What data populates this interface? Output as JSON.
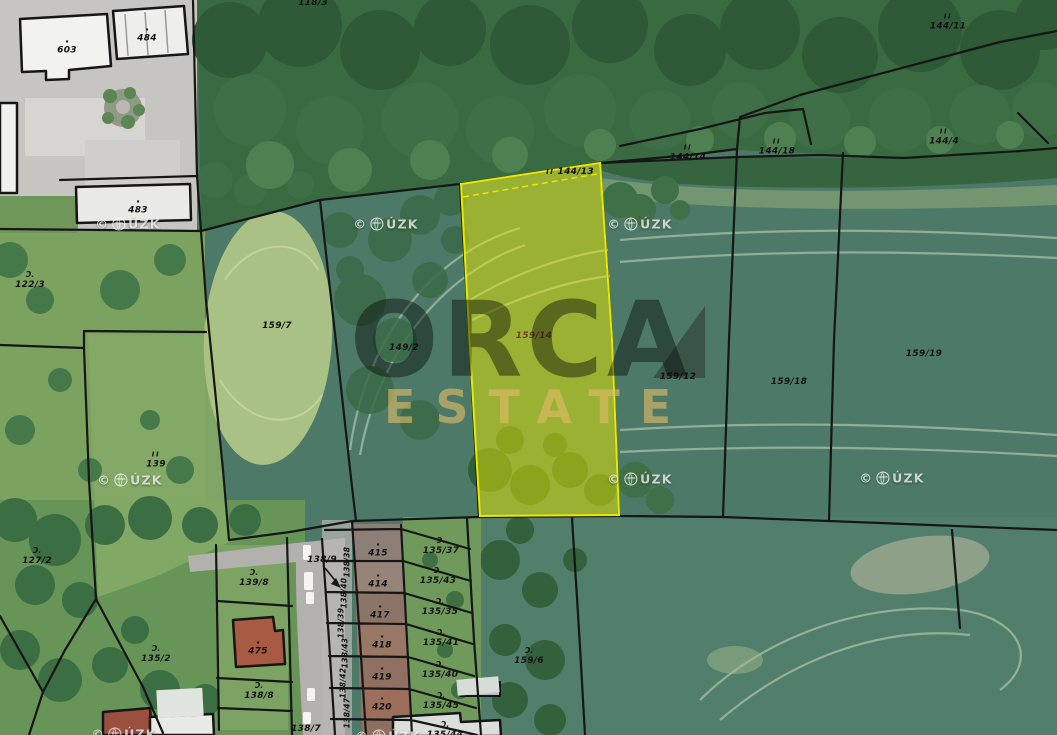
{
  "app": {
    "type": "cadastral-aerial-map",
    "provider": "ČÚZK",
    "brand": "ORCA ESTATE"
  },
  "map": {
    "brand_watermark": {
      "line1": "ORCA",
      "line2": "ESTATE"
    },
    "watermark": {
      "copyright": "©",
      "org": "ČÚZK",
      "org_suffix": "ÚZK",
      "positions": [
        {
          "x": 128,
          "y": 224
        },
        {
          "x": 386,
          "y": 224
        },
        {
          "x": 640,
          "y": 224
        },
        {
          "x": 130,
          "y": 480
        },
        {
          "x": 640,
          "y": 479
        },
        {
          "x": 892,
          "y": 478
        },
        {
          "x": 124,
          "y": 734
        },
        {
          "x": 388,
          "y": 736
        }
      ]
    },
    "highlight": {
      "parcel": "159/14",
      "stroke": "#eaea00",
      "fill": "rgba(232,232,0,0.5)"
    },
    "colors": {
      "boundary": "#161616",
      "forest": "#3a6a42",
      "field": "#4d7a68",
      "meadow": "#a9c184",
      "road": "#b2b1ad",
      "building": "#f2f2ef",
      "roof_red": "#a1543f",
      "highlight": "#eaea00"
    },
    "labels": [
      {
        "t": "603",
        "x": 67,
        "y": 47,
        "s": "dot"
      },
      {
        "t": "484",
        "x": 147,
        "y": 35,
        "s": "dot"
      },
      {
        "t": "483",
        "x": 138,
        "y": 207,
        "s": "dot"
      },
      {
        "t": "118/3",
        "x": 313,
        "y": 3
      },
      {
        "t": "144/11",
        "x": 948,
        "y": 22,
        "s": "II"
      },
      {
        "t": "144/14",
        "x": 688,
        "y": 153,
        "s": "II"
      },
      {
        "t": "144/18",
        "x": 777,
        "y": 147,
        "s": "II"
      },
      {
        "t": "144/4",
        "x": 944,
        "y": 137,
        "s": "II"
      },
      {
        "t": "144/13",
        "x": 570,
        "y": 172,
        "s": "II-inline"
      },
      {
        "t": "122/3",
        "x": 30,
        "y": 280,
        "s": "orchard"
      },
      {
        "t": "159/7",
        "x": 277,
        "y": 326
      },
      {
        "t": "149/2",
        "x": 404,
        "y": 348
      },
      {
        "t": "159/14",
        "x": 534,
        "y": 336,
        "c": "#7a3a28",
        "n": "highlighted-parcel-label"
      },
      {
        "t": "159/12",
        "x": 678,
        "y": 377
      },
      {
        "t": "159/18",
        "x": 789,
        "y": 382
      },
      {
        "t": "159/19",
        "x": 924,
        "y": 354
      },
      {
        "t": "139",
        "x": 156,
        "y": 460,
        "s": "II"
      },
      {
        "t": "127/2",
        "x": 37,
        "y": 556,
        "s": "orchard"
      },
      {
        "t": "139/8",
        "x": 254,
        "y": 578,
        "s": "orchard"
      },
      {
        "t": "138/9",
        "x": 322,
        "y": 560
      },
      {
        "t": "135/2",
        "x": 156,
        "y": 654,
        "s": "orchard"
      },
      {
        "t": "475",
        "x": 258,
        "y": 648,
        "s": "dot"
      },
      {
        "t": "138/8",
        "x": 259,
        "y": 691,
        "s": "orchard"
      },
      {
        "t": "138/7",
        "x": 306,
        "y": 729
      },
      {
        "t": "159/6",
        "x": 529,
        "y": 656,
        "s": "orchard"
      },
      {
        "t": "415",
        "x": 378,
        "y": 550,
        "s": "dot"
      },
      {
        "t": "414",
        "x": 378,
        "y": 581,
        "s": "dot"
      },
      {
        "t": "417",
        "x": 380,
        "y": 612,
        "s": "dot"
      },
      {
        "t": "418",
        "x": 382,
        "y": 642,
        "s": "dot"
      },
      {
        "t": "419",
        "x": 382,
        "y": 674,
        "s": "dot"
      },
      {
        "t": "420",
        "x": 382,
        "y": 704,
        "s": "dot"
      },
      {
        "t": "138/38",
        "x": 347,
        "y": 562,
        "r": -90
      },
      {
        "t": "138/40",
        "x": 344,
        "y": 593,
        "r": -90
      },
      {
        "t": "138/39",
        "x": 341,
        "y": 623,
        "r": -90
      },
      {
        "t": "138/43",
        "x": 345,
        "y": 653,
        "r": -90
      },
      {
        "t": "138/42",
        "x": 343,
        "y": 683,
        "r": -90
      },
      {
        "t": "138/47",
        "x": 347,
        "y": 713,
        "r": -90
      },
      {
        "t": "135/37",
        "x": 441,
        "y": 546,
        "s": "orchard"
      },
      {
        "t": "135/43",
        "x": 438,
        "y": 576,
        "s": "orchard"
      },
      {
        "t": "135/35",
        "x": 440,
        "y": 607,
        "s": "orchard"
      },
      {
        "t": "135/41",
        "x": 441,
        "y": 638,
        "s": "orchard"
      },
      {
        "t": "135/40",
        "x": 440,
        "y": 670,
        "s": "orchard"
      },
      {
        "t": "135/45",
        "x": 441,
        "y": 701,
        "s": "orchard"
      },
      {
        "t": "135/44",
        "x": 445,
        "y": 730,
        "s": "orchard"
      }
    ]
  }
}
